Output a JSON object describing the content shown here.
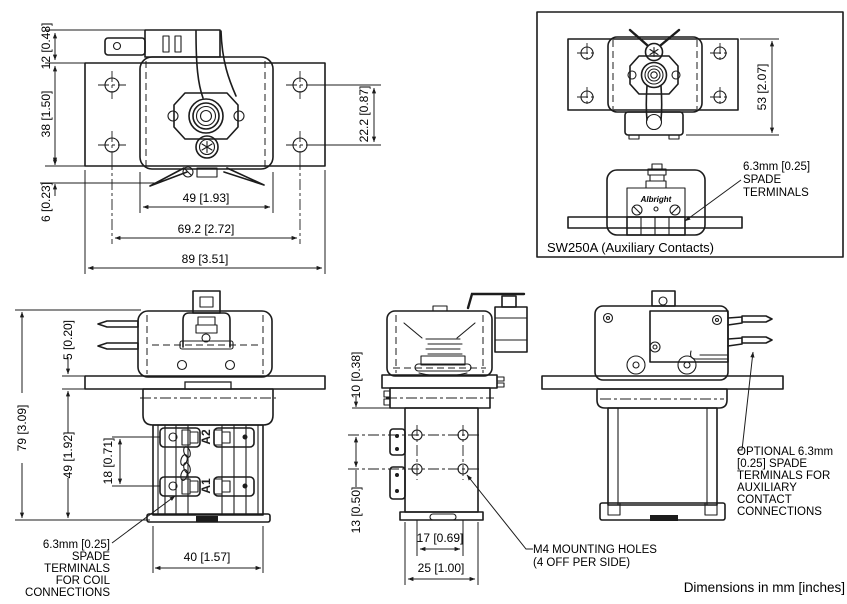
{
  "footer": {
    "note": "Dimensions in mm [inches]"
  },
  "colors": {
    "line": "#1c1c1c",
    "background": "#ffffff"
  },
  "top_view": {
    "dims": {
      "tab_height": "12 [0.48]",
      "plate_height": "38 [1.50]",
      "lead_offset": "6 [0.23]",
      "hole_spacing_vertical": "22.2 [0.87]",
      "body_width": "49 [1.93]",
      "hole_spacing_horizontal": "69.2 [2.72]",
      "plate_width": "89 [3.51]"
    }
  },
  "aux_box": {
    "caption": "SW250A (Auxiliary Contacts)",
    "dims": {
      "height": "53 [2.07]"
    },
    "spade_note": [
      "6.3mm [0.25]",
      "SPADE",
      "TERMINALS"
    ],
    "logo": "Albright"
  },
  "front_view": {
    "dims": {
      "overall_height": "79 [3.09]",
      "bracket_thickness": "5 [0.20]",
      "lower_height": "49 [1.92]",
      "coil_terminal_spacing": "18 [0.71]",
      "body_width": "40 [1.57]"
    },
    "terminals": {
      "a2": "A2",
      "a1": "A1"
    },
    "coil_note": [
      "6.3mm [0.25]",
      "SPADE",
      "TERMINALS",
      "FOR COIL",
      "CONNECTIONS"
    ]
  },
  "side_view": {
    "dims": {
      "hole_top_offset": "10 [0.38]",
      "hole_spacing_vertical": "13 [0.50]",
      "hole_spacing_horizontal": "17 [0.69]",
      "body_depth": "25 [1.00]"
    },
    "mounting_note": [
      "M4 MOUNTING HOLES",
      "(4 OFF PER SIDE)"
    ]
  },
  "aux_side_view": {
    "aux_note": [
      "OPTIONAL 6.3mm",
      "[0.25] SPADE",
      "TERMINALS FOR",
      "AUXILIARY",
      "CONTACT",
      "CONNECTIONS"
    ]
  }
}
